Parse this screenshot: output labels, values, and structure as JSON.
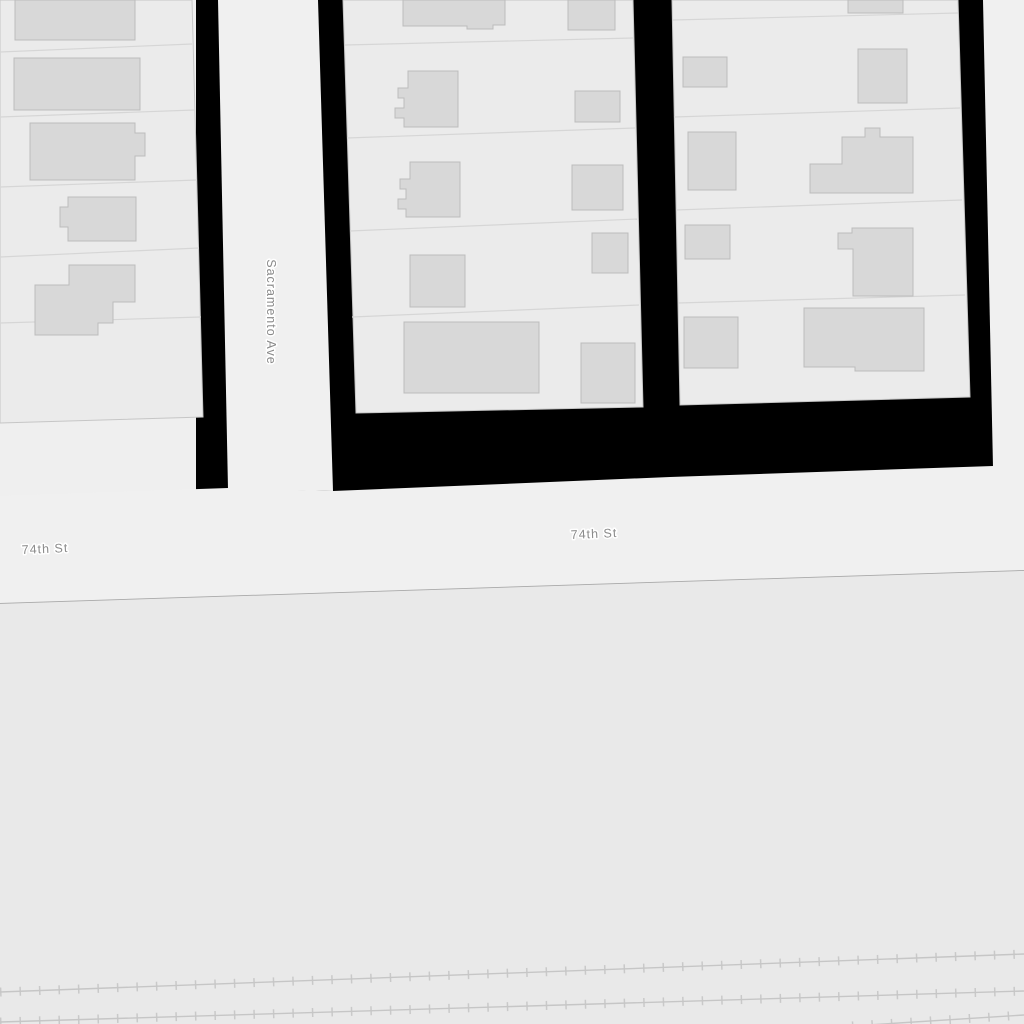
{
  "map": {
    "labels": {
      "vertical_street": "Sacramento Ave",
      "horizontal_street_left": "74th St",
      "horizontal_street_center": "74th St"
    },
    "colors": {
      "block_fill": "#ebebeb",
      "road_fill": "#f0f0f0",
      "building_fill": "#d8d8d8",
      "building_stroke": "#bcbcbc",
      "unmapped_area": "#000000",
      "open_area_fill": "#e9e9e9",
      "railway_stroke": "#c9c9c9",
      "label_text": "#8a8a8a",
      "boundary_line": "#a9a9a9"
    }
  }
}
